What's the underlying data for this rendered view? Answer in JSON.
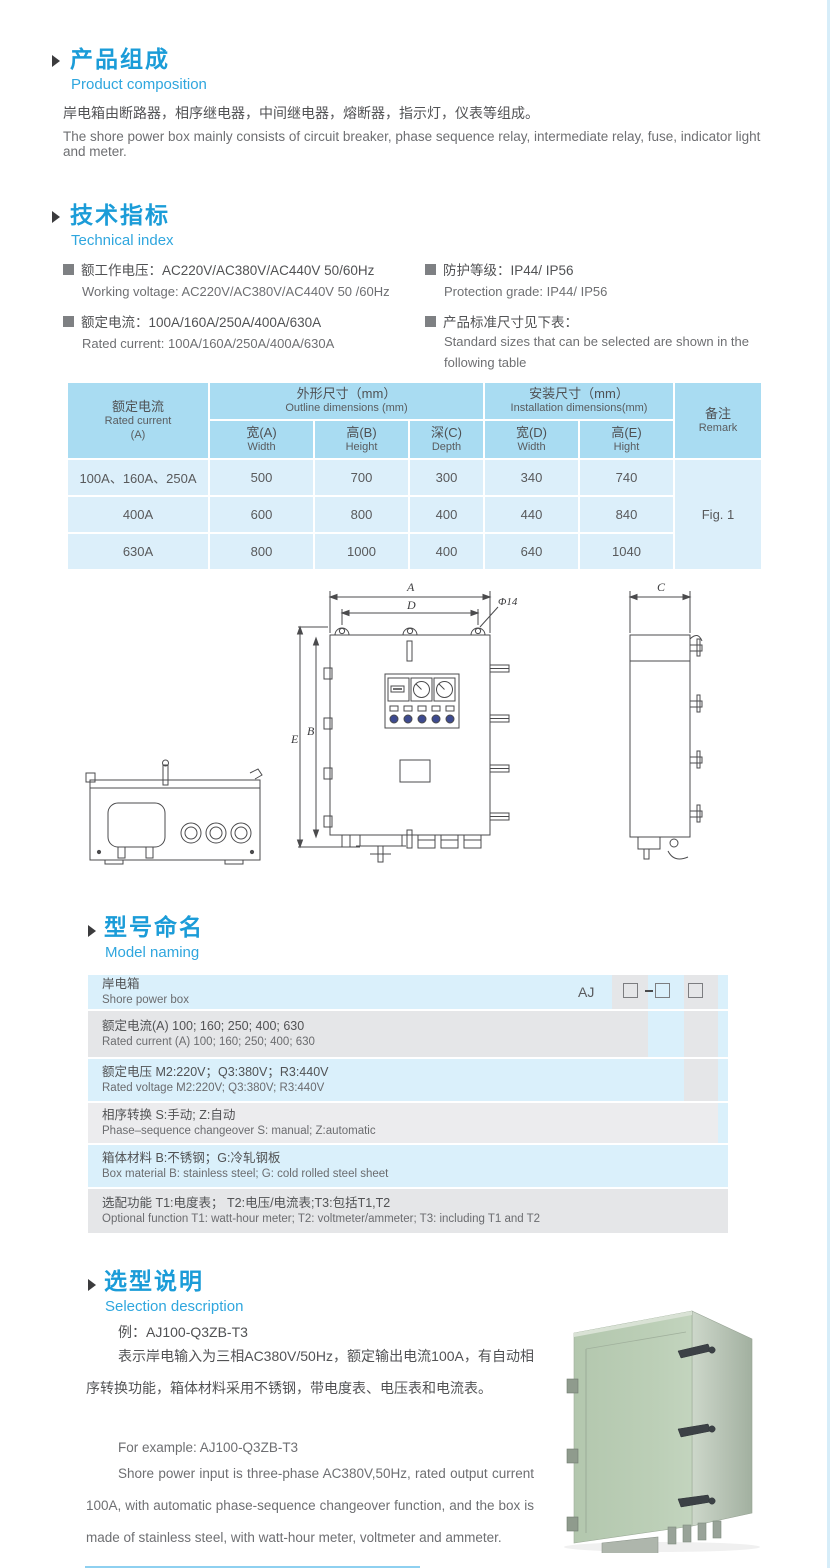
{
  "composition": {
    "heading_cn": "产品组成",
    "heading_en": "Product  composition",
    "body_cn": "岸电箱由断路器，相序继电器，中间继电器，熔断器，指示灯，仪表等组成。",
    "body_en": "The shore power box mainly consists of circuit breaker, phase sequence relay, intermediate relay, fuse, indicator light and meter."
  },
  "technical": {
    "heading_cn": "技术指标",
    "heading_en": "Technical index",
    "specs": [
      {
        "cn": "额工作电压：AC220V/AC380V/AC440V  50/60Hz",
        "en": "Working voltage: AC220V/AC380V/AC440V 50 /60Hz"
      },
      {
        "cn": "额定电流：100A/160A/250A/400A/630A",
        "en": "Rated current: 100A/160A/250A/400A/630A"
      },
      {
        "cn": "防护等级：IP44/ IP56",
        "en": "Protection grade: IP44/ IP56"
      },
      {
        "cn": "产品标准尺寸见下表：",
        "en": "Standard sizes that can be selected are shown in the following table"
      }
    ]
  },
  "size_table": {
    "rated_cn": "额定电流",
    "rated_en": "Rated current",
    "rated_unit": "(A)",
    "outline_cn": "外形尺寸（mm）",
    "outline_en": "Outline dimensions (mm)",
    "install_cn": "安装尺寸（mm）",
    "install_en": "Installation dimensions(mm)",
    "remark_cn": "备注",
    "remark_en": "Remark",
    "sub": [
      {
        "cn": "宽(A)",
        "en": "Width"
      },
      {
        "cn": "高(B)",
        "en": "Height"
      },
      {
        "cn": "深(C)",
        "en": "Depth"
      },
      {
        "cn": "宽(D)",
        "en": "Width"
      },
      {
        "cn": "高(E)",
        "en": "Hight"
      }
    ],
    "rows": [
      [
        "100A、160A、250A",
        "500",
        "700",
        "300",
        "340",
        "740"
      ],
      [
        "400A",
        "600",
        "800",
        "400",
        "440",
        "840"
      ],
      [
        "630A",
        "800",
        "1000",
        "400",
        "640",
        "1040"
      ]
    ],
    "remark_value": "Fig. 1"
  },
  "drawing": {
    "labels": {
      "a": "A",
      "d": "D",
      "b": "B",
      "e": "E",
      "c": "C",
      "phi": "Φ14"
    }
  },
  "naming": {
    "heading_cn": "型号命名",
    "heading_en": "Model naming",
    "prefix": "AJ",
    "rows": [
      {
        "cn": "岸电箱",
        "en": "Shore power box"
      },
      {
        "cn": "额定电流(A)  100; 160; 250; 400; 630",
        "en": "Rated current (A) 100; 160; 250; 400; 630"
      },
      {
        "cn": "额定电压  M2:220V；Q3:380V；R3:440V",
        "en": "Rated voltage  M2:220V;  Q3:380V;  R3:440V"
      },
      {
        "cn": "相序转换  S:手动; Z:自动",
        "en": "Phase–sequence changeover  S: manual;  Z:automatic"
      },
      {
        "cn": "箱体材料  B:不锈钢；G:冷轧钢板",
        "en": "Box material  B: stainless steel; G: cold rolled steel sheet"
      },
      {
        "cn": "选配功能  T1:电度表； T2:电压/电流表;T3:包括T1,T2",
        "en": "Optional function  T1: watt-hour meter; T2: voltmeter/ammeter; T3: including T1 and T2"
      }
    ]
  },
  "selection": {
    "heading_cn": "选型说明",
    "heading_en": "Selection description",
    "example_cn": "例：AJ100-Q3ZB-T3",
    "body_cn": "表示岸电输入为三相AC380V/50Hz，额定输出电流100A，有自动相序转换功能，箱体材料采用不锈钢，带电度表、电压表和电流表。",
    "example_en": "For example: AJ100-Q3ZB-T3",
    "body_en": "Shore power input is three-phase AC380V,50Hz, rated output current 100A, with automatic phase-sequence changeover function, and the box is made of stainless steel, with watt-hour meter, voltmeter and ammeter."
  },
  "colors": {
    "heading_blue": "#1b9cd8",
    "subtitle_blue": "#2fa6de",
    "table_header_bg": "#a9dcf2",
    "table_row_bg": "#dceffa",
    "naming_blue": "#daf0fb",
    "naming_grey": "#e5e6e8",
    "photo_green": "#b9ccb4"
  }
}
